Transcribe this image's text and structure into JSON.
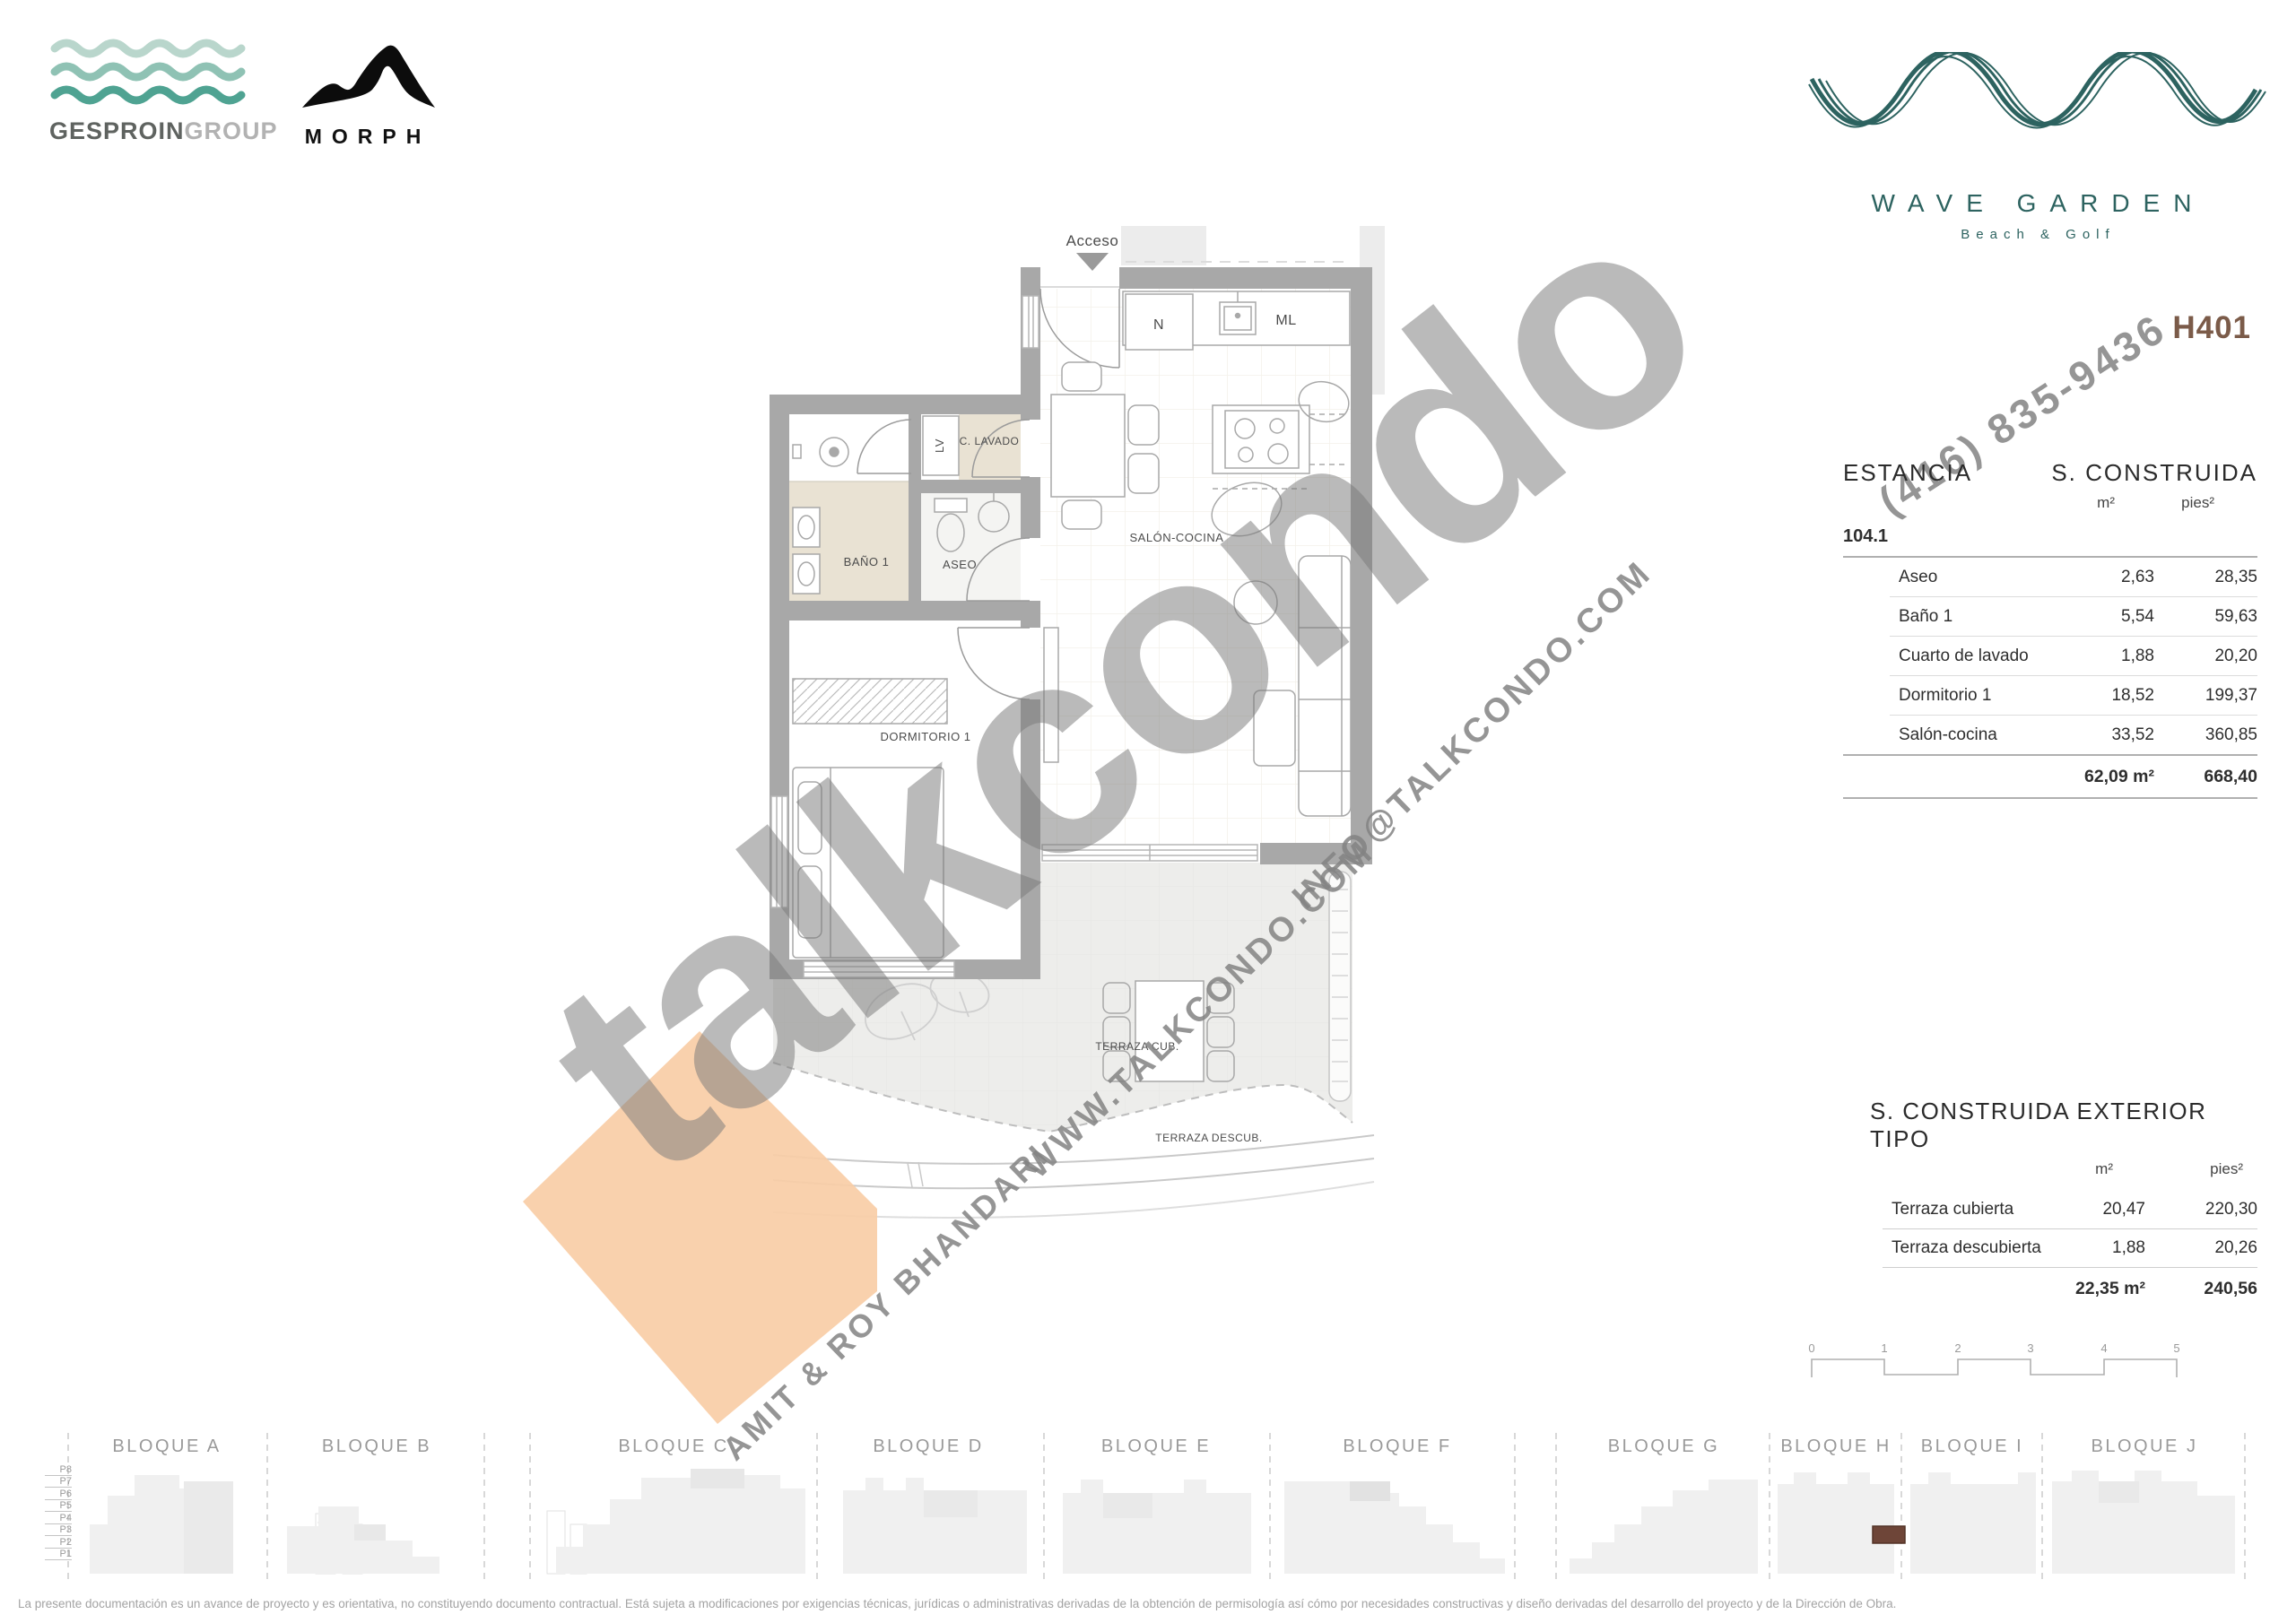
{
  "branding": {
    "gesproin_bold": "GESPROIN",
    "gesproin_light": "GROUP",
    "morph": "MORPH",
    "wave_garden_title": "WAVE GARDEN",
    "wave_garden_subtitle": "Beach & Golf",
    "unit_code": "H401",
    "accent_teal": "#2d6360",
    "unit_code_color": "#7b5b49"
  },
  "floor_plan": {
    "labels": {
      "acceso": "Acceso",
      "n": "N",
      "ml": "ML",
      "c_lavado": "C. LAVADO",
      "lv": "LV",
      "bano1": "BAÑO 1",
      "aseo": "ASEO",
      "dormitorio1": "DORMITORIO 1",
      "salon_cocina": "SALÓN-COCINA",
      "terraza_cub": "TERRAZA CUB.",
      "terraza_descub": "TERRAZA DESCUB."
    },
    "highlight_diamond_color": "#f8cda6"
  },
  "watermark": {
    "brand": "talkcondo",
    "phone": "(416) 835-9436",
    "email": "INFO@TALKCONDO.COM",
    "website": "WWW.TALKCONDO.COM",
    "agents": "AMIT & ROY BHANDARI"
  },
  "main_table": {
    "col_estancia": "ESTANCIA",
    "col_construida": "S. CONSTRUIDA",
    "unit_m2": "m²",
    "unit_pies2": "pies²",
    "group": "104.1",
    "rows": [
      {
        "name": "Aseo",
        "m2": "2,63",
        "pies2": "28,35"
      },
      {
        "name": "Baño 1",
        "m2": "5,54",
        "pies2": "59,63"
      },
      {
        "name": "Cuarto de lavado",
        "m2": "1,88",
        "pies2": "20,20"
      },
      {
        "name": "Dormitorio 1",
        "m2": "18,52",
        "pies2": "199,37"
      },
      {
        "name": "Salón-cocina",
        "m2": "33,52",
        "pies2": "360,85"
      }
    ],
    "total": {
      "m2": "62,09 m²",
      "pies2": "668,40"
    }
  },
  "exterior_table": {
    "title": "S. CONSTRUIDA EXTERIOR TIPO",
    "unit_m2": "m²",
    "unit_pies2": "pies²",
    "rows": [
      {
        "name": "Terraza cubierta",
        "m2": "20,47",
        "pies2": "220,30"
      },
      {
        "name": "Terraza descubierta",
        "m2": "1,88",
        "pies2": "20,26"
      }
    ],
    "total": {
      "m2": "22,35 m²",
      "pies2": "240,56"
    }
  },
  "scale_bar": {
    "ticks": [
      "0",
      "1",
      "2",
      "3",
      "4",
      "5"
    ]
  },
  "blocks": {
    "items": [
      {
        "label": "BLOQUE A"
      },
      {
        "label": "BLOQUE B"
      },
      {
        "label": "BLOQUE C"
      },
      {
        "label": "BLOQUE D"
      },
      {
        "label": "BLOQUE E"
      },
      {
        "label": "BLOQUE F"
      },
      {
        "label": "BLOQUE G"
      },
      {
        "label": "BLOQUE H"
      },
      {
        "label": "BLOQUE I"
      },
      {
        "label": "BLOQUE J"
      }
    ],
    "floors": [
      "P8",
      "P7",
      "P6",
      "P5",
      "P4",
      "P3",
      "P2",
      "P1"
    ],
    "highlight_color": "#6e4538"
  },
  "footer": {
    "disclaimer": "La presente documentación es un avance de proyecto y es orientativa, no constituyendo documento contractual. Está sujeta a modificaciones por exigencias técnicas, jurídicas o administrativas derivadas de la obtención de permisología así cómo por necesidades constructivas y diseño derivadas del desarrollo del proyecto y de la Dirección de Obra."
  }
}
